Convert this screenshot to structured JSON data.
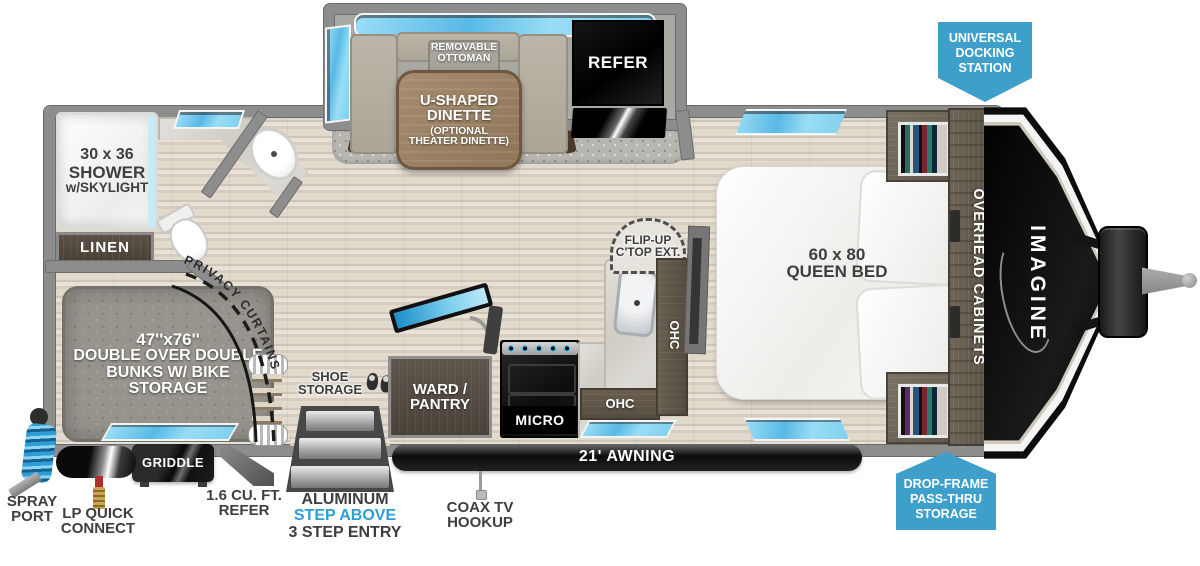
{
  "colors": {
    "badge_blue": "#3E9FCB",
    "step_accent_blue": "#2E9CD6",
    "window_blue": "#8ED9F2"
  },
  "logo": {
    "brand": "IMAGINE"
  },
  "badges": {
    "docking": [
      "UNIVERSAL",
      "DOCKING",
      "STATION"
    ],
    "pass_thru": [
      "DROP-FRAME",
      "PASS-THRU",
      "STORAGE"
    ]
  },
  "bathroom": {
    "shower": [
      "30 x 36",
      "SHOWER",
      "w/SKYLIGHT"
    ],
    "linen": "LINEN"
  },
  "bunk_room": {
    "bunks": [
      "47''x76''",
      "DOUBLE OVER DOUBLE",
      "BUNKS W/ BIKE STORAGE"
    ],
    "privacy_curtains": "PRIVACY CURTAINS"
  },
  "dinette": {
    "ottoman": [
      "REMOVABLE",
      "OTTOMAN"
    ],
    "table": [
      "U-SHAPED",
      "DINETTE",
      "(OPTIONAL",
      "THEATER DINETTE)"
    ],
    "refer": "REFER"
  },
  "kitchen": {
    "flip_up": [
      "FLIP-UP",
      "C'TOP EXT."
    ],
    "ohc_side": "OHC",
    "ohc_lower": "OHC",
    "micro": "MICRO",
    "ward_pantry": [
      "WARD /",
      "PANTRY"
    ],
    "shoe_storage": [
      "SHOE",
      "STORAGE"
    ]
  },
  "bedroom": {
    "bed": [
      "60 x 80",
      "QUEEN BED"
    ],
    "overhead_cabinets": "OVERHEAD CABINETS"
  },
  "exterior": {
    "awning": "21' AWNING",
    "spray_port": [
      "SPRAY",
      "PORT"
    ],
    "lp_connect": [
      "LP QUICK",
      "CONNECT"
    ],
    "griddle": "GRIDDLE",
    "mini_refer": [
      "1.6 CU. FT.",
      "REFER"
    ],
    "entry_steps": [
      "ALUMINUM",
      "STEP ABOVE",
      "3 STEP ENTRY"
    ],
    "coax": [
      "COAX TV",
      "HOOKUP"
    ]
  }
}
